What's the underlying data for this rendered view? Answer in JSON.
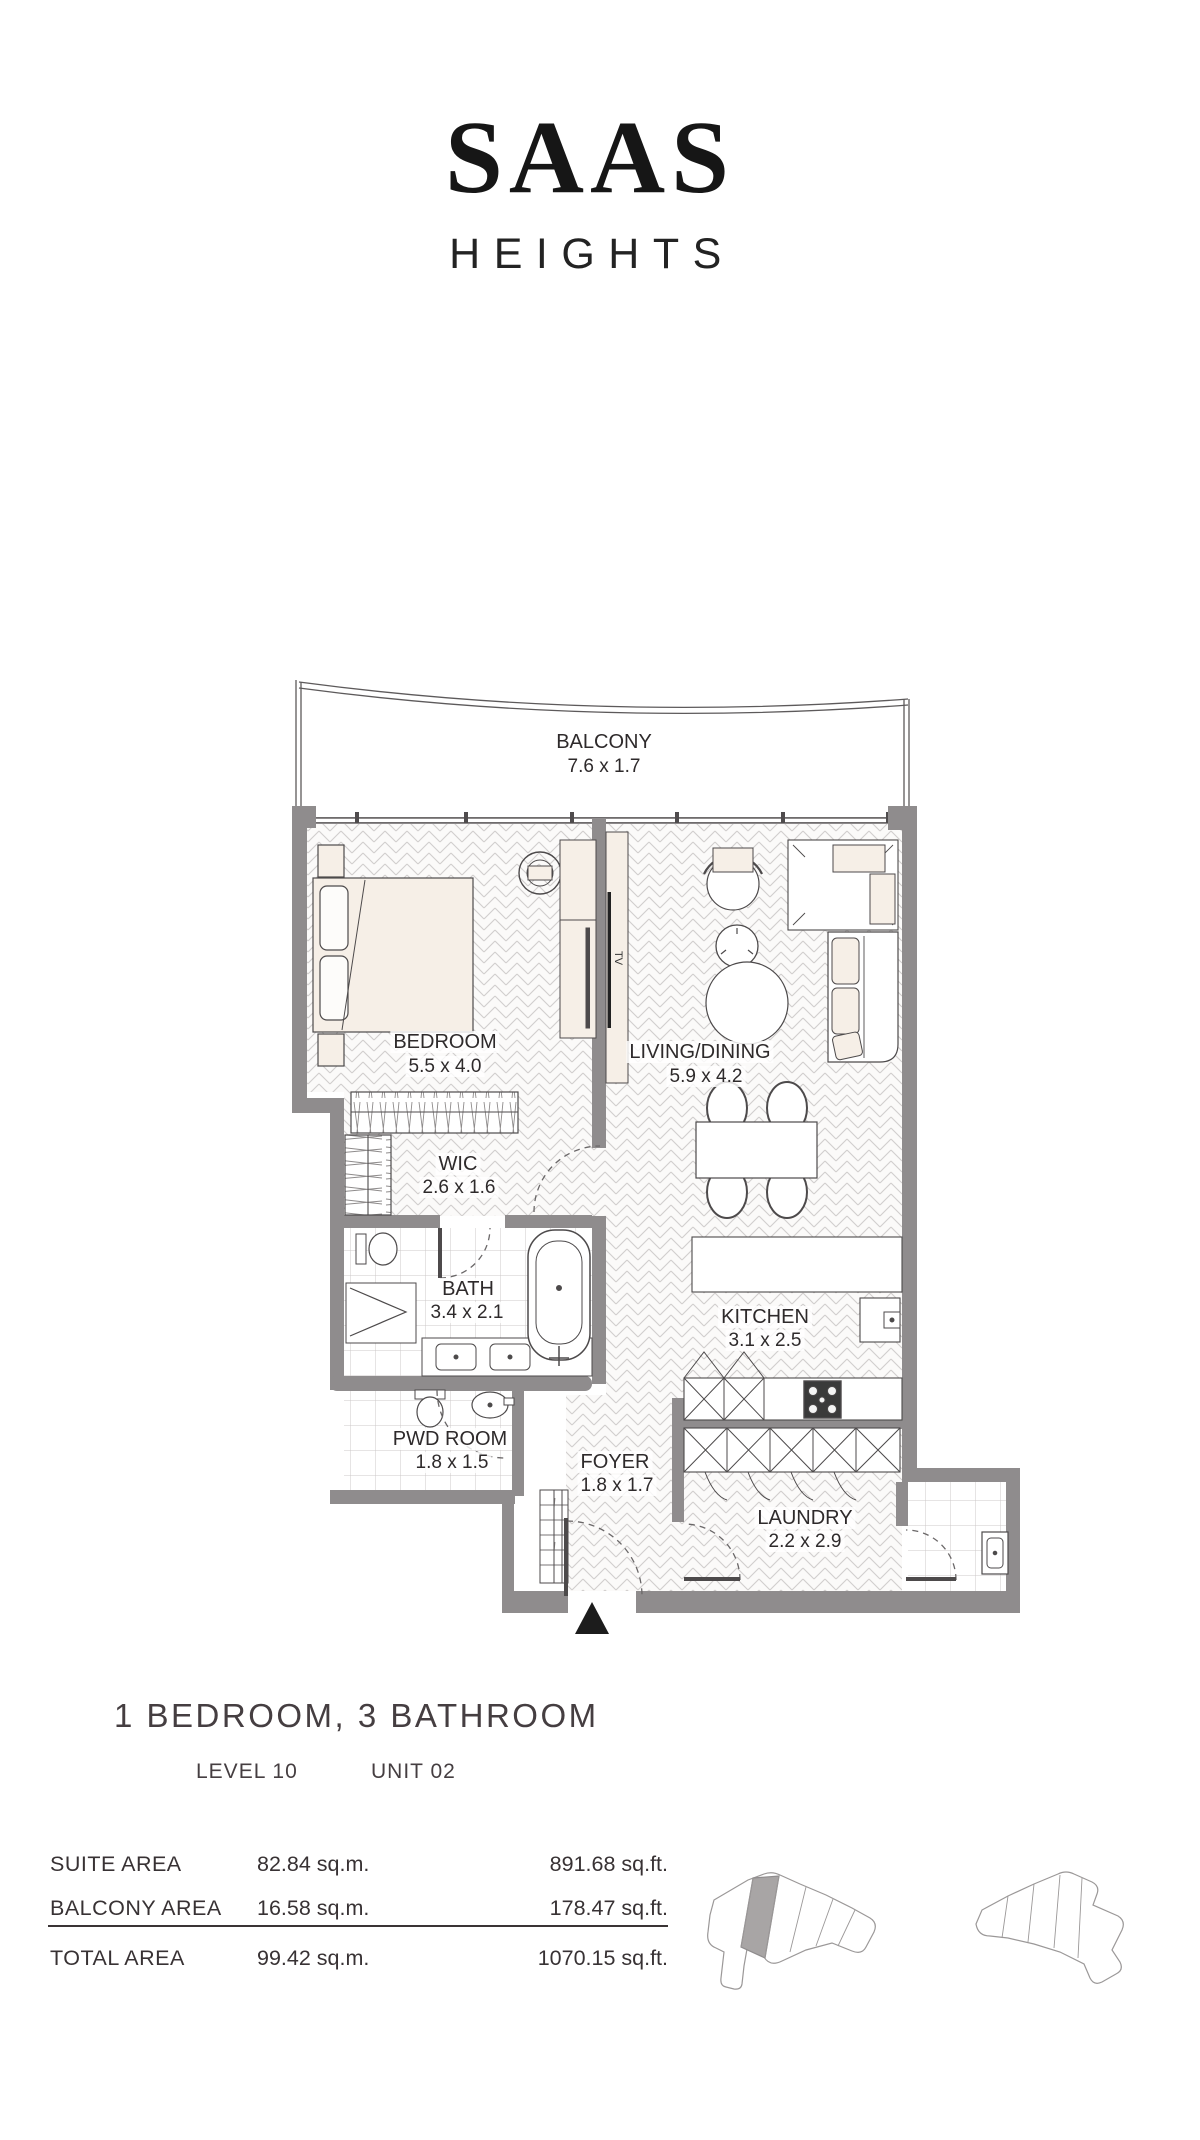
{
  "brand": {
    "name": "SAAS",
    "tagline": "HEIGHTS"
  },
  "floor_plan": {
    "tv_label": "TV",
    "rooms": [
      {
        "id": "balcony",
        "label": "BALCONY",
        "dims": "7.6 x 1.7"
      },
      {
        "id": "bedroom",
        "label": "BEDROOM",
        "dims": "5.5 x 4.0"
      },
      {
        "id": "living-dining",
        "label": "LIVING/DINING",
        "dims": "5.9 x 4.2"
      },
      {
        "id": "wic",
        "label": "WIC",
        "dims": "2.6 x 1.6"
      },
      {
        "id": "bath",
        "label": "BATH",
        "dims": "3.4 x 2.1"
      },
      {
        "id": "kitchen",
        "label": "KITCHEN",
        "dims": "3.1 x 2.5"
      },
      {
        "id": "pwd-room",
        "label": "PWD ROOM",
        "dims": "1.8 x 1.5"
      },
      {
        "id": "foyer",
        "label": "FOYER",
        "dims": "1.8 x 1.7"
      },
      {
        "id": "laundry",
        "label": "LAUNDRY",
        "dims": "2.2 x 2.9"
      }
    ]
  },
  "unit_info": {
    "title": "1 BEDROOM, 3 BATHROOM",
    "level": "LEVEL 10",
    "unit": "UNIT 02"
  },
  "area_table": {
    "rows": [
      {
        "label": "SUITE AREA",
        "metric": "82.84 sq.m.",
        "imperial": "891.68 sq.ft."
      },
      {
        "label": "BALCONY AREA",
        "metric": "16.58 sq.m.",
        "imperial": "178.47 sq.ft."
      },
      {
        "label": "TOTAL AREA",
        "metric": "99.42 sq.m.",
        "imperial": "1070.15 sq.ft."
      }
    ]
  },
  "colors": {
    "wall": "#8f8c8d",
    "furniture": "#f6efe7",
    "text": "#3c3638",
    "highlight_unit": "#a8a5a5"
  }
}
